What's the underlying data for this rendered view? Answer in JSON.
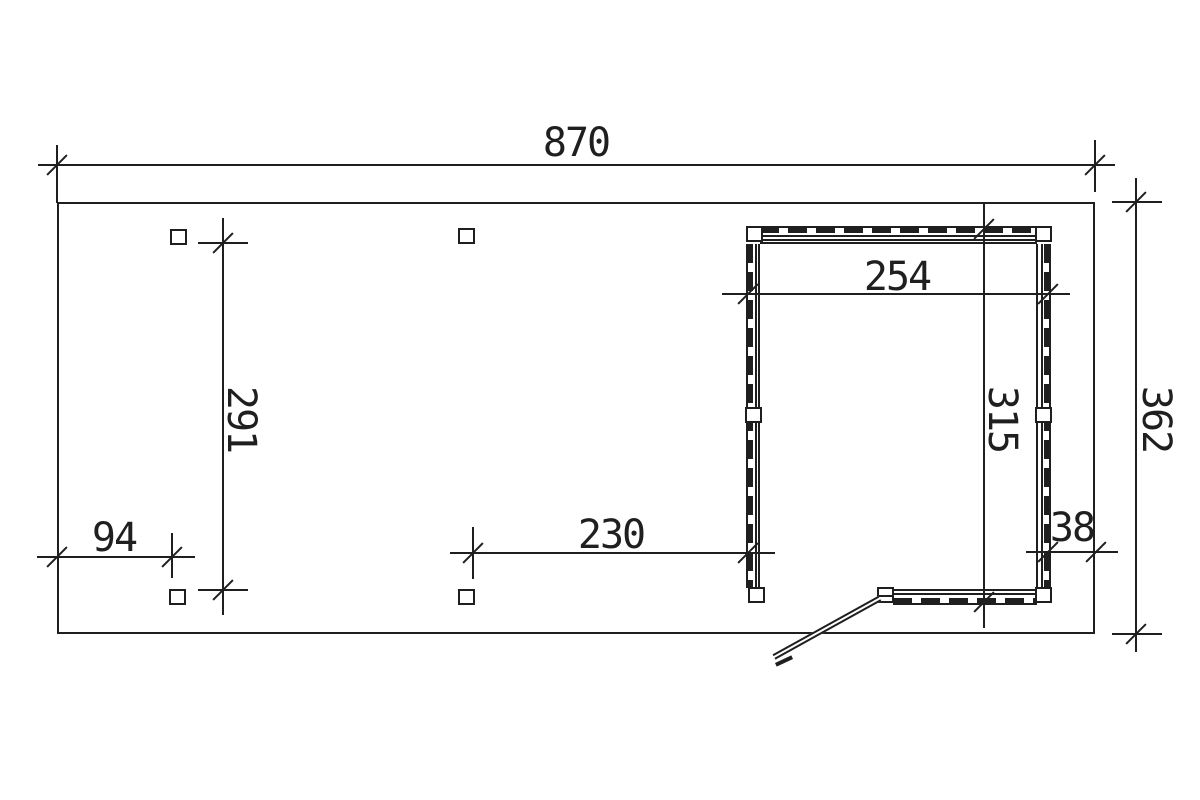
{
  "drawing": {
    "type": "carport-floor-plan",
    "colors": {
      "background": "#ffffff",
      "line": "#1f1f1f"
    }
  },
  "dimensions": {
    "overall_width": "870",
    "overall_depth": "362",
    "post_bay_depth": "291",
    "front_left_bay": "94",
    "carport_bay": "230",
    "room_width": "254",
    "room_depth": "315",
    "right_margin": "38"
  }
}
